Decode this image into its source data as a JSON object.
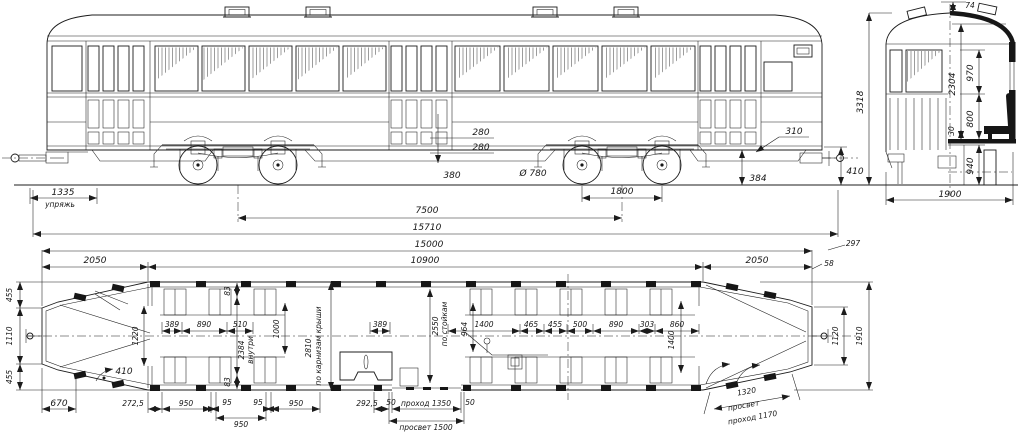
{
  "colors": {
    "ink": "#1c1c1c",
    "paper": "#ffffff"
  },
  "side": {
    "coupling": "1335",
    "coupling_note": "упряжь",
    "level_a": "280",
    "level_b": "280",
    "step_front": "380",
    "wheel_dia": "Ø 780",
    "wheelbase": "1800",
    "step_rear": "310",
    "height_384": "384",
    "buffer_410": "410",
    "bogie_centers": "7500",
    "length_over_buffers": "15710",
    "length_body": "15000",
    "length_center": "10900",
    "overhang_left": "2050",
    "overhang_right": "2050",
    "offset_297": "297",
    "offset_58": "58"
  },
  "end": {
    "top_74": "74",
    "height_3318": "3318",
    "interior_2304": "2304",
    "dim_970": "970",
    "dim_800": "800",
    "dim_30": "30",
    "floor_940": "940",
    "width_1900": "1900"
  },
  "plan": {
    "left_455a": "455",
    "left_1110": "1110",
    "left_455b": "455",
    "front_670": "670",
    "door_410": "410",
    "bulkhead_1220": "1220",
    "pillar_83t": "83",
    "pillar_83b": "83",
    "inner_2384": "2384",
    "inner_note": "внутри",
    "seat_389a": "389",
    "seat_890a": "890",
    "seat_510": "510",
    "seat_1000": "1000",
    "roof_2810": "2810",
    "roof_note": "по карнизам крыши",
    "mid_389": "389",
    "posts_2550": "2550",
    "posts_note": "по стойкам",
    "dim_964": "964",
    "mid_1400": "1400",
    "mid_465": "465",
    "mid_455": "455",
    "mid_500": "500",
    "mid_890": "890",
    "mid_303": "303",
    "mid_860": "860",
    "right_1400": "1400",
    "bot_272": "272,5",
    "bot_950a": "950",
    "bot_95a": "95",
    "bot_95b": "95",
    "bot_950b": "950",
    "bot_950c": "950",
    "bot_292": "292,5",
    "bot_50a": "50",
    "passage_1350": "проход 1350",
    "bot_50b": "50",
    "clearance_1500": "просвет 1500",
    "rear_1320": "1320",
    "rear_note": "просвет",
    "rear_passage": "проход 1170",
    "end_1120": "1120",
    "width_1910": "1910"
  }
}
